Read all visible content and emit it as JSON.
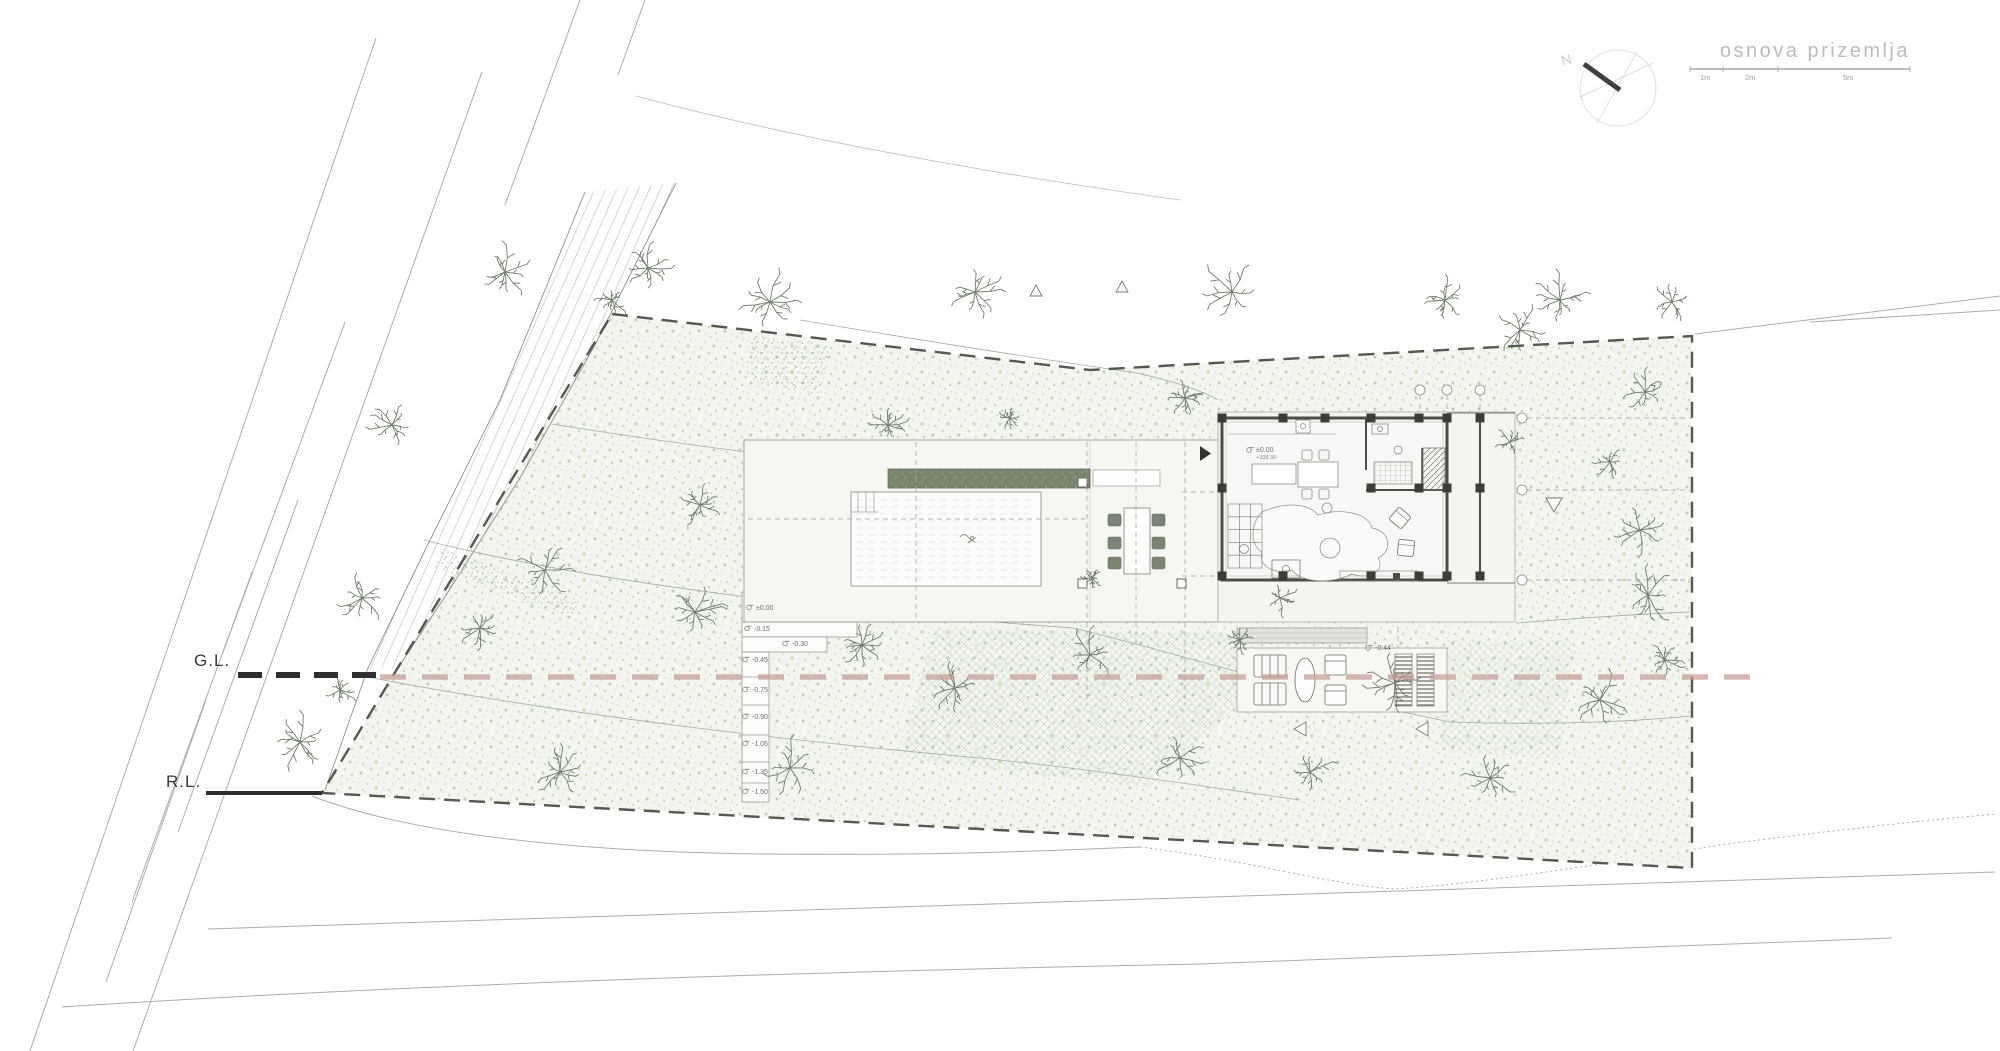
{
  "header": {
    "title": "osnova prizemlja",
    "compass_label": "N",
    "scale_labels": [
      "1m",
      "2m",
      "5m"
    ]
  },
  "ground_lines": {
    "gl_label": "G.L.",
    "rl_label": "R.L."
  },
  "house_level_marker": {
    "relative": "±0.00",
    "absolute": "+338.30"
  },
  "terrace_level_marker": "-0.44",
  "exterior_steps_markers": [
    {
      "value": "±0.00",
      "x": 756,
      "y": 610
    },
    {
      "value": "-0.15",
      "x": 754,
      "y": 631
    },
    {
      "value": "-0.30",
      "x": 792,
      "y": 646
    },
    {
      "value": "-0.45",
      "x": 752,
      "y": 662
    },
    {
      "value": "-0.75",
      "x": 752,
      "y": 692
    },
    {
      "value": "-0.90",
      "x": 752,
      "y": 719
    },
    {
      "value": "-1.05",
      "x": 752,
      "y": 746
    },
    {
      "value": "-1.35",
      "x": 752,
      "y": 774
    },
    {
      "value": "-1.50",
      "x": 752,
      "y": 794
    }
  ],
  "colors": {
    "ground_line_pink": "#c59d97",
    "boundary_dash": "#474b42",
    "tree_stroke": "#5d6c55",
    "wall": "#4a4e46",
    "ground_line_black": "#2f2f2f"
  }
}
